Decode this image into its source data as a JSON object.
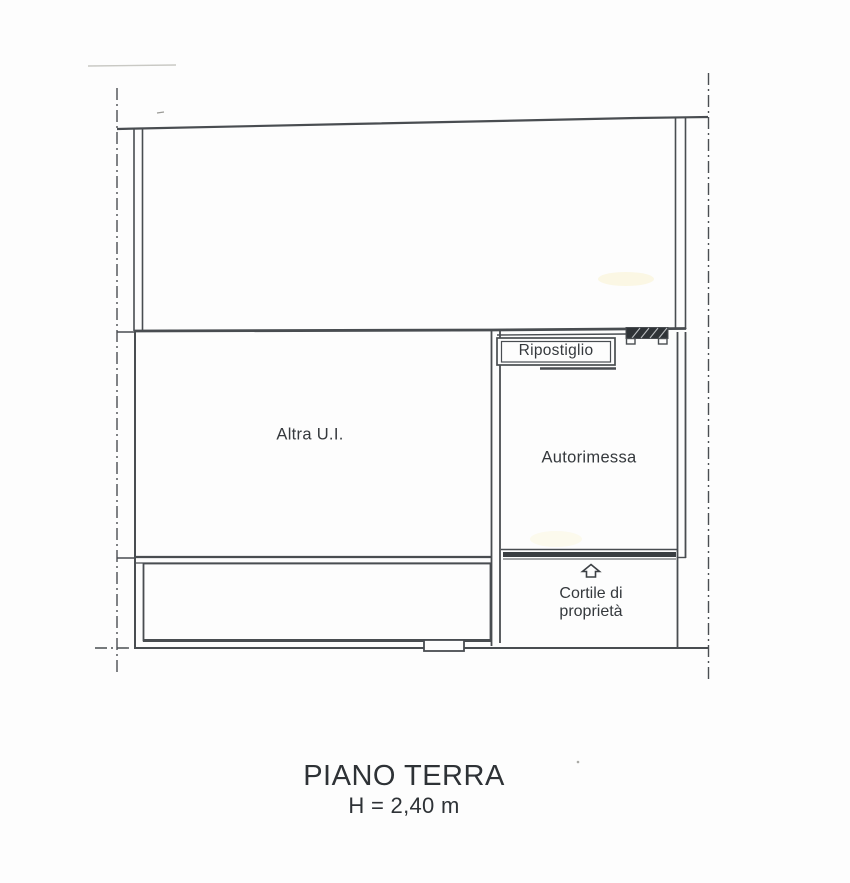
{
  "plan": {
    "labels": {
      "altra_ui": "Altra U.I.",
      "ripostiglio": "Ripostiglio",
      "autorimessa": "Autorimessa",
      "cortile_line1": "Cortile di",
      "cortile_line2": "proprietà"
    },
    "icons": {
      "entrance_arrow": "up-arrow-icon",
      "door_threshold": "hatched-door-sill"
    }
  },
  "title_block": {
    "floor": "PIANO TERRA",
    "height": "H = 2,40 m"
  },
  "colors": {
    "line": "#494d51",
    "text": "#2e3236",
    "highlight": "#faf3cf",
    "background": "#fdfdfd"
  }
}
